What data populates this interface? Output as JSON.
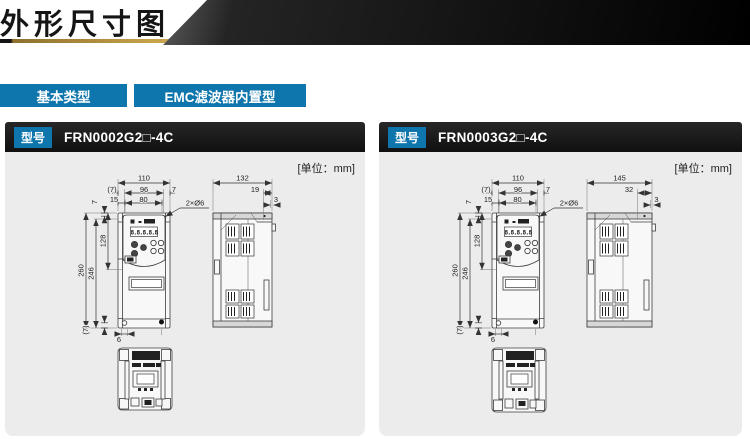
{
  "header": {
    "title": "外形尺寸图"
  },
  "tabs": [
    {
      "label": "基本类型"
    },
    {
      "label": "EMC滤波器内置型"
    }
  ],
  "badge_label": "型号",
  "unit_label": "[单位：mm]",
  "colors": {
    "accent_blue": "#0f76ad",
    "banner_black": "#141414",
    "gold_line": "#c7a34a",
    "panel_bg": "#ececec"
  },
  "panels": [
    {
      "model": "FRN0002G2□-4C",
      "display": "8.8.8.8.8",
      "dims": {
        "width": "110",
        "w7l": "(7)",
        "w96": "96",
        "w7r": "7",
        "w15": "15",
        "w80": "80",
        "holes": "2×Ø6",
        "h7": "7",
        "h128": "128",
        "h260": "260",
        "h246": "246",
        "b7": "(7)",
        "b6": "6",
        "depth": "132",
        "step": "19",
        "edge": "3"
      }
    },
    {
      "model": "FRN0003G2□-4C",
      "display": "8.8.8.8.8",
      "dims": {
        "width": "110",
        "w7l": "(7)",
        "w96": "96",
        "w7r": "7",
        "w15": "15",
        "w80": "80",
        "holes": "2×Ø6",
        "h7": "7",
        "h128": "128",
        "h260": "260",
        "h246": "246",
        "b7": "(7)",
        "b6": "6",
        "depth": "145",
        "step": "32",
        "edge": "3"
      }
    }
  ]
}
